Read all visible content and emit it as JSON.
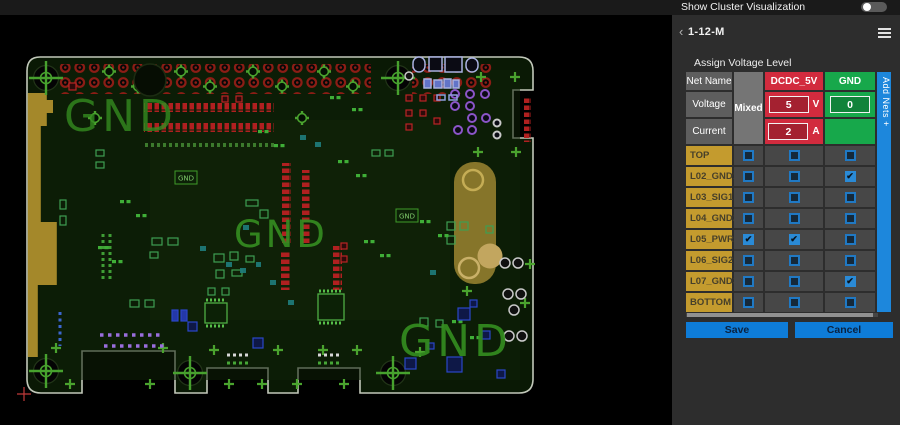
{
  "window": {
    "top_bar": {
      "toggle_label": "Show Cluster Visualization",
      "toggle_state": "off"
    }
  },
  "panel": {
    "header": {
      "back_icon": "‹",
      "title": "1-12-M"
    },
    "section_title": "Assign Voltage Level",
    "table": {
      "row_headers": {
        "net_name": "Net Name",
        "voltage": "Voltage",
        "current": "Current"
      },
      "mixed_label": "Mixed",
      "nets": [
        {
          "name": "DCDC_5V",
          "color": "#d22b3e",
          "voltage": "5",
          "voltage_unit": "V",
          "current": "2",
          "current_unit": "A"
        },
        {
          "name": "GND",
          "color": "#17a84b",
          "voltage": "0",
          "voltage_unit": "",
          "current": "",
          "current_unit": ""
        }
      ],
      "add_nets_label": "Add Nets +",
      "layers": [
        {
          "name": "TOP",
          "checks": [
            false,
            false,
            false
          ]
        },
        {
          "name": "L02_GND1",
          "checks": [
            false,
            false,
            true
          ]
        },
        {
          "name": "L03_SIG1",
          "checks": [
            false,
            false,
            false
          ]
        },
        {
          "name": "L04_GND2",
          "checks": [
            false,
            false,
            false
          ]
        },
        {
          "name": "L05_PWR1",
          "checks": [
            true,
            true,
            false
          ]
        },
        {
          "name": "L06_SIG2",
          "checks": [
            false,
            false,
            false
          ]
        },
        {
          "name": "L07_GND3",
          "checks": [
            false,
            false,
            true
          ]
        },
        {
          "name": "BOTTOM",
          "checks": [
            false,
            false,
            false
          ]
        }
      ]
    },
    "buttons": {
      "save": "Save",
      "cancel": "Cancel"
    }
  },
  "pcb": {
    "gnd_large": [
      "GND",
      "GND",
      "GND"
    ],
    "gnd_small": [
      "GND",
      "GND"
    ]
  },
  "colors": {
    "net_red": "#d22b3e",
    "net_green": "#17a84b",
    "accent_blue": "#0e7cd8",
    "layer_gold": "#c49b2e",
    "add_nets_blue": "#1d87dc",
    "board_green": "#0a1905"
  }
}
